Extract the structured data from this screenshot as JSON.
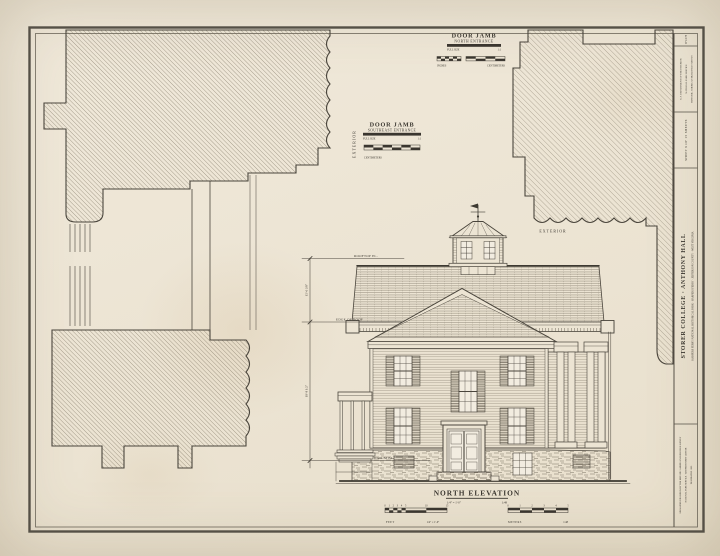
{
  "sheet": {
    "paper_color": "#ece4d3",
    "ink_color": "#44403a"
  },
  "details": {
    "north_jamb": {
      "title": "DOOR JAMB",
      "subtitle": "NORTH ENTRANCE",
      "scale_note_left": "FULL SIZE",
      "scale_note_right": "1:1",
      "inches_label": "INCHES",
      "centimeters_label": "CENTIMETERS",
      "exterior_label": "EXTERIOR"
    },
    "southeast_jamb": {
      "title": "DOOR JAMB",
      "subtitle": "SOUTHEAST ENTRANCE",
      "scale_note_left": "FULL SIZE",
      "scale_note_right": "1:1",
      "centimeters_label": "CENTIMETERS",
      "exterior_label": "EXTERIOR"
    }
  },
  "elevation": {
    "title": "NORTH ELEVATION",
    "scale_note_left": "1/4\" = 1'-0\"",
    "scale_note_right": "1:48",
    "feet_label": "FEET",
    "feet_scale": "1/4\" = 1'-0\"",
    "meters_label": "METERS",
    "meters_scale": "1:48",
    "feet_ticks": [
      "0",
      "1",
      "2",
      "3",
      "4",
      "5",
      "10",
      "15"
    ],
    "meters_ticks": [
      "0",
      "1",
      "2",
      "3",
      "4",
      "5"
    ],
    "annotations": {
      "rooftop": "ROOFTOP EL.",
      "edge_of_roof": "EDGE OF ROOF",
      "datum": "DATUM EL.",
      "dim_upper": "15'-6 3/8\"",
      "dim_lower": "18'-8 1/2\""
    }
  },
  "titleblock": {
    "survey_no": "WV-179",
    "dept_line": "U.S. DEPARTMENT OF THE INTERIOR",
    "service_line": "NATIONAL PARK SERVICE",
    "survey_line": "HISTORIC AMERICAN BUILDINGS SURVEY",
    "sheet_info": "SHEET 9 OF 15 SHEETS",
    "title": "STORER COLLEGE · ANTHONY HALL",
    "subtitle": "HARPERS FERRY NATIONAL HISTORICAL PARK · HARPERS FERRY · JEFFERSON COUNTY · WEST VIRGINIA",
    "credit_line_1": "MEASURED DRAWINGS BY THE HISTORIC AMERICAN BUILDINGS SURVEY",
    "credit_line_2": "NATIONAL PARK SERVICE · HARPERS FERRY CENTER",
    "credit_line_3": "DELINEATED 1999"
  }
}
